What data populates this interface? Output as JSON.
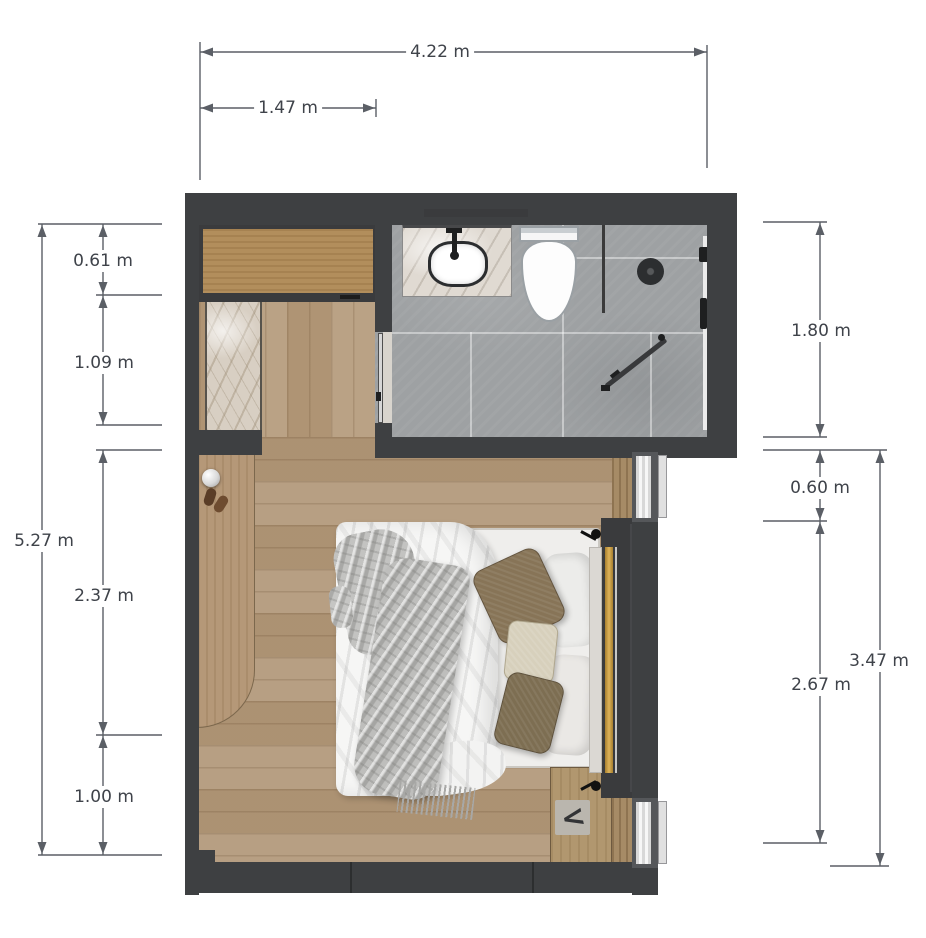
{
  "dimensions": {
    "width_total": "4.22 m",
    "width_closet": "1.47 m",
    "wardrobe_depth": "0.61 m",
    "closet_depth": "1.09 m",
    "room_height_total": "5.27 m",
    "bed_zone": "2.37 m",
    "bottom_zone": "1.00 m",
    "bathroom_depth": "1.80 m",
    "window_width": "0.60 m",
    "window_wall_lower": "2.67 m",
    "window_wall_total": "3.47 m"
  },
  "nightstand": {
    "glyph": "<"
  },
  "colors": {
    "wall": "#3e4042",
    "floor_wood": "#b2987a",
    "bathroom_tile": "#9ea1a3",
    "accent_gold": "#c79d44",
    "marble": "#d8cfc3",
    "dimension_line": "#5b5f66"
  }
}
